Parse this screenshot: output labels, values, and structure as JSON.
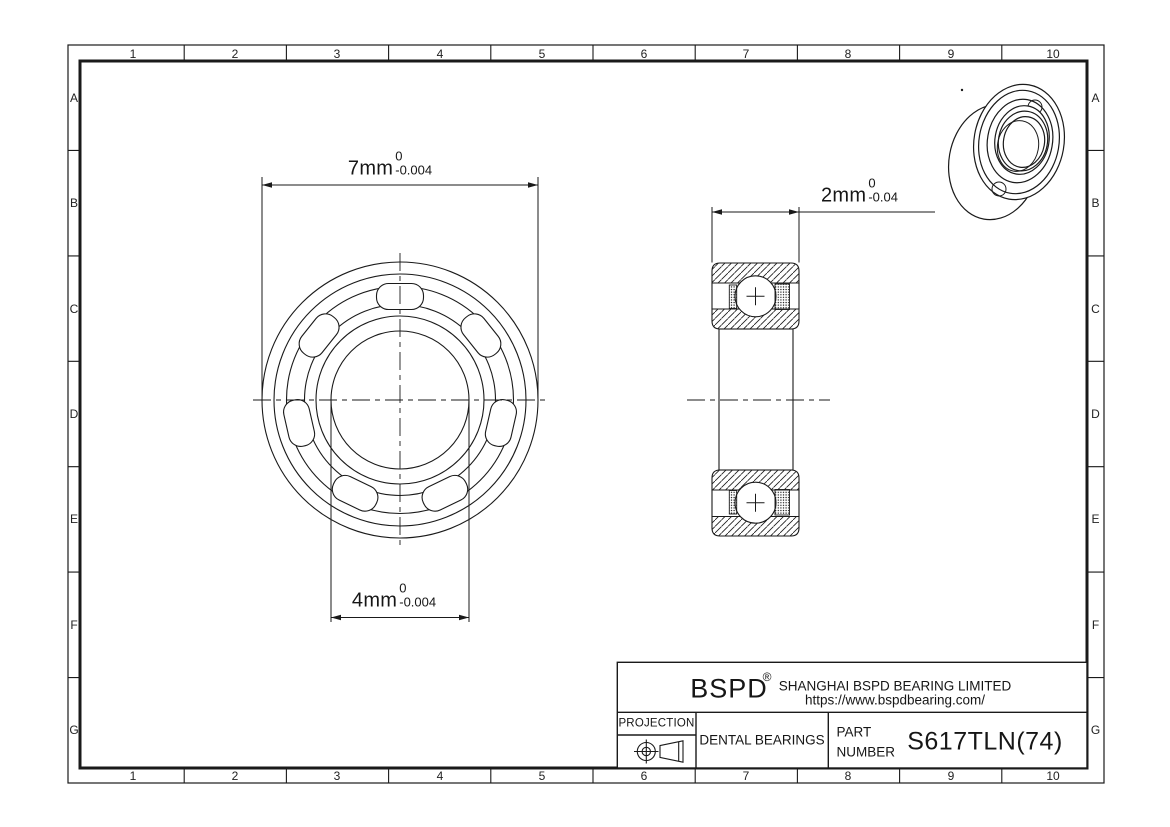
{
  "grid": {
    "columns": [
      "1",
      "2",
      "3",
      "4",
      "5",
      "6",
      "7",
      "8",
      "9",
      "10"
    ],
    "rows": [
      "A",
      "B",
      "C",
      "D",
      "E",
      "F",
      "G"
    ]
  },
  "dimensions": {
    "outer_diameter": {
      "value": "7mm",
      "tolerance_upper": "0",
      "tolerance_lower": "-0.004"
    },
    "bore_diameter": {
      "value": "4mm",
      "tolerance_upper": "0",
      "tolerance_lower": "-0.004"
    },
    "width": {
      "value": "2mm",
      "tolerance_upper": "0",
      "tolerance_lower": "-0.04"
    }
  },
  "title_block": {
    "brand": "BSPD",
    "registered_mark": "®",
    "company": "SHANGHAI BSPD BEARING LIMITED",
    "website": "https://www.bspdbearing.com/",
    "projection_label": "PROJECTION",
    "product_type": "DENTAL BEARINGS",
    "part_label_line1": "PART",
    "part_label_line2": "NUMBER",
    "part_number": "S617TLN(74)"
  },
  "colors": {
    "line": "#1a1a1a",
    "background": "#ffffff"
  }
}
